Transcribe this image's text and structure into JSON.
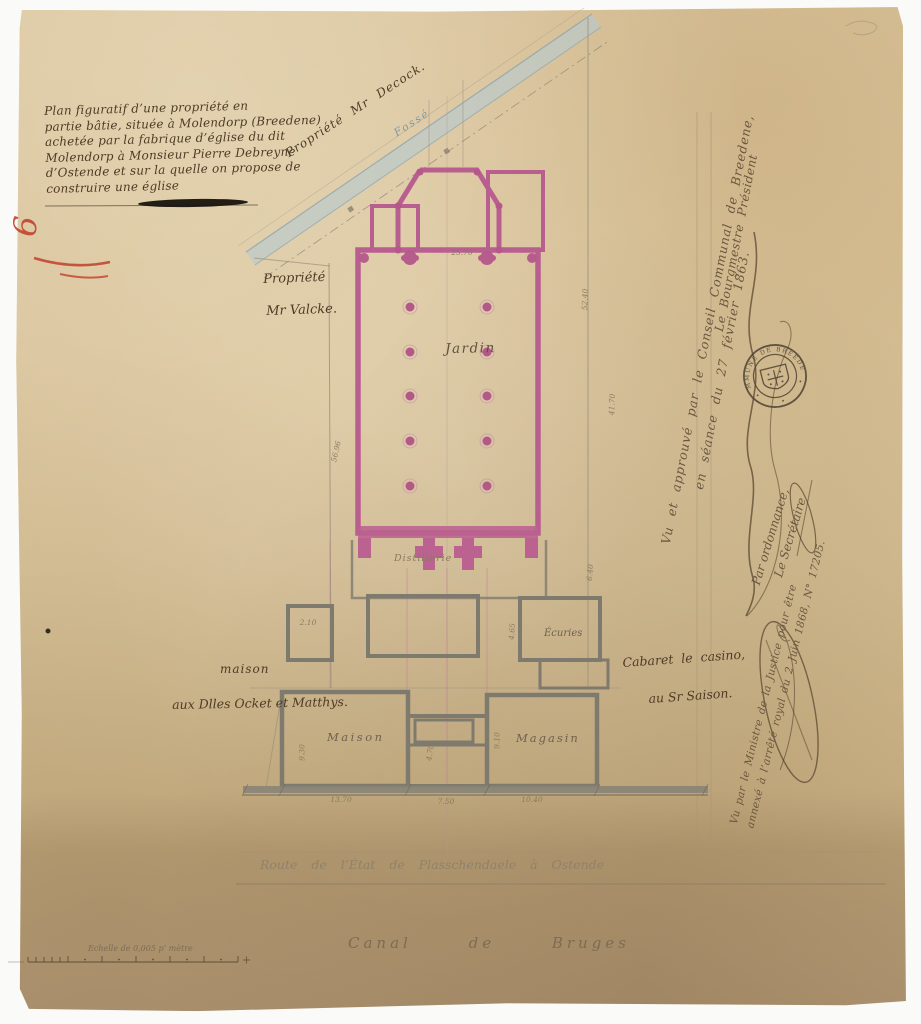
{
  "palette": {
    "paper": "#d4bd92",
    "ink": "#4f3a26",
    "plan_pink": "#b95f90",
    "water_blue": "#b7cad0",
    "crayon_red": "#c0402a",
    "wall_gray": "#7f7a6e"
  },
  "title_block": {
    "lines": [
      "Plan figuratif d’une propriété en",
      "partie bâtie, située à Molendorp (Breedene)",
      "achetée par la fabrique d’église du dit",
      "Molendorp à Monsieur Pierre Debreyne",
      "d’Ostende et sur la quelle on propose de",
      "construire une église"
    ]
  },
  "margin_mark": "9",
  "labels": {
    "property_top": "Propriété Mr Decock.",
    "ditch": "Fossé",
    "property_left_1": "Propriété",
    "property_left_2": "Mr Valcke.",
    "garden": "Jardin",
    "distillery": "Distillerie",
    "stables": "Écuries",
    "house_owner_1": "maison",
    "house_owner_2": "aux Dlles Ocket et Matthys.",
    "house": "Maison",
    "store": "Magasin",
    "cabaret_1": "Cabaret le casino,",
    "cabaret_2": "au Sr Saison.",
    "road": "Route de l’État de Plasschendaele à Ostende",
    "canal": "Canal de Bruges",
    "scale": "Echelle de 0,005 p’ mètre"
  },
  "dimensions": {
    "nave_width": "25.70",
    "right_upper": "52.40",
    "right_lower": "41.70",
    "left_side": "56.96",
    "stable_height": "6.40",
    "stable_width": "4.65",
    "shed": "2.10",
    "house_height": "9.30",
    "store_height": "9.10",
    "house_width": "13.70",
    "middle_width": "7.50",
    "store_width": "10.40",
    "middle_height": "4.70"
  },
  "approval": {
    "line1": "Vu et approuvé par le Conseil Communal de Breedene,",
    "line2": "en séance du 27 février 1863.",
    "title": "Le Bourgmestre Président",
    "ordinance": "Par ordonnance,",
    "secretary": "Le Secrétaire"
  },
  "seal": {
    "text": "COMMUNE DE BREEDENE"
  },
  "justice": {
    "line1": "Vu par le Ministre de la Justice pour être",
    "line2": "annexé à l’arrêté royal du 2 Juin 1868, N° 17205."
  }
}
